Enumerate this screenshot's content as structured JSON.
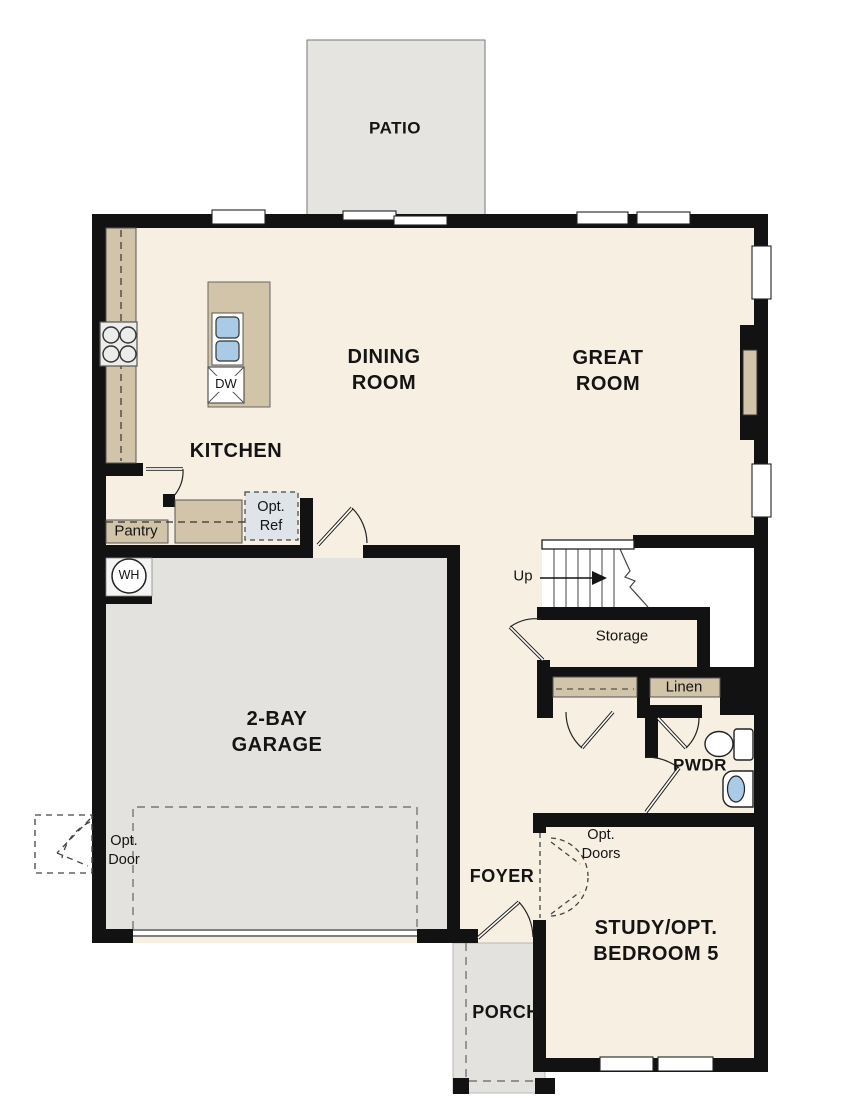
{
  "plan": {
    "rooms": {
      "patio": "PATIO",
      "dining_room": "DINING\nROOM",
      "great_room": "GREAT\nROOM",
      "kitchen": "KITCHEN",
      "pantry": "Pantry",
      "garage": "2-BAY\nGARAGE",
      "storage": "Storage",
      "linen": "Linen",
      "powder": "PWDR",
      "foyer": "FOYER",
      "study": "STUDY/OPT.\nBEDROOM 5",
      "porch": "PORCH"
    },
    "fixtures": {
      "dishwasher": "DW",
      "water_heater": "WH"
    },
    "annotations": {
      "up": "Up",
      "opt_ref": "Opt.\nRef",
      "opt_door": "Opt.\nDoor",
      "opt_doors": "Opt.\nDoors"
    },
    "colors": {
      "wall": "#121212",
      "floor": "#f7efe2",
      "garage_floor": "#e3e2df",
      "patio_floor": "#e5e4e1",
      "counter": "#d2c4a8",
      "sink_blue": "#a9cbe8",
      "optional_ref_fill": "#dfe4e8",
      "window": "#ffffff"
    }
  }
}
